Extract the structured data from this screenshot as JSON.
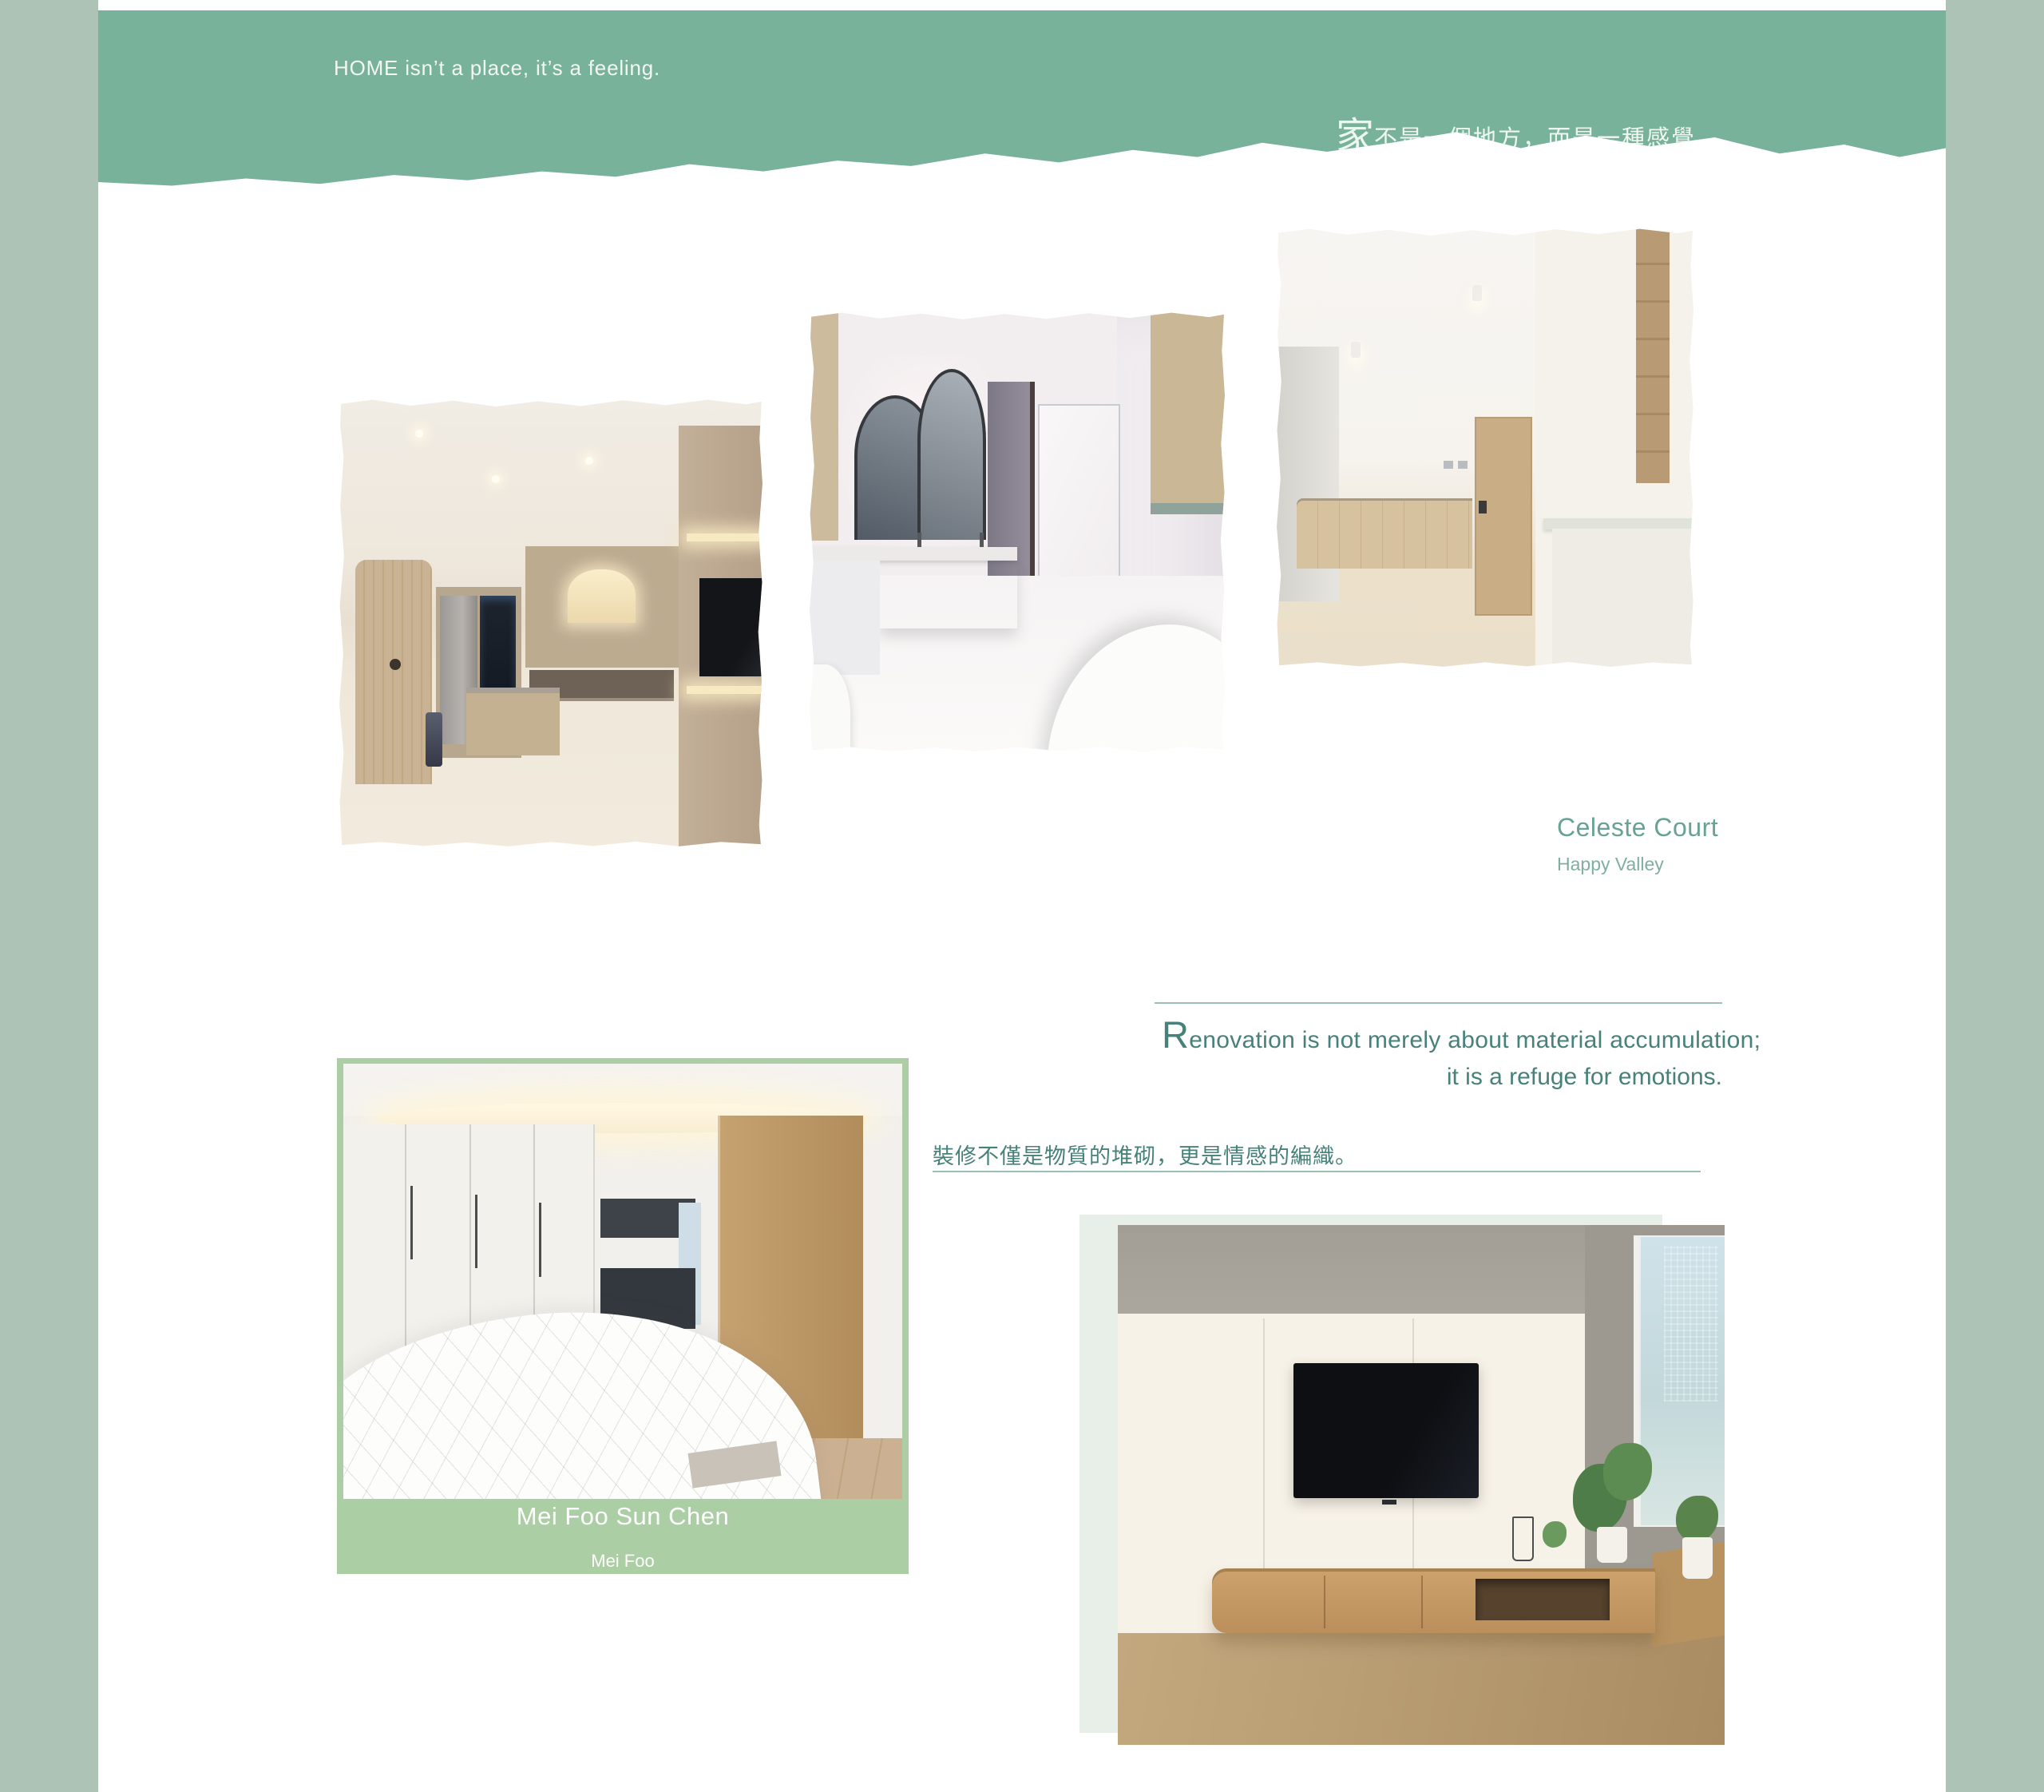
{
  "palette": {
    "header-green": "#78b29a",
    "side-margin": "#adc3b5",
    "card-green": "#abcea5",
    "pale-block": "#e8efe9",
    "teal-text": "#46817a",
    "title-green": "#68a293",
    "subtitle-green": "#7fafa0",
    "hr-green": "#9cc0b4",
    "hero-text": "#f3f7f2"
  },
  "hero": {
    "quote_en": "HOME isn’t a place, it’s a feeling.",
    "quote_zh_lead": "家",
    "quote_zh_rest": "不是一個地方，而是一種感覺。"
  },
  "project_celeste": {
    "name": "Celeste Court",
    "location": "Happy Valley"
  },
  "quote_block": {
    "en_initial": "R",
    "en_line1_rest": "enovation is not merely about material accumulation;",
    "en_line2": "it is a refuge for emotions.",
    "zh": "裝修不僅是物質的堆砌，更是情感的編織。"
  },
  "project_meifoo": {
    "name": "Mei Foo Sun Chen",
    "location": "Mei Foo"
  }
}
